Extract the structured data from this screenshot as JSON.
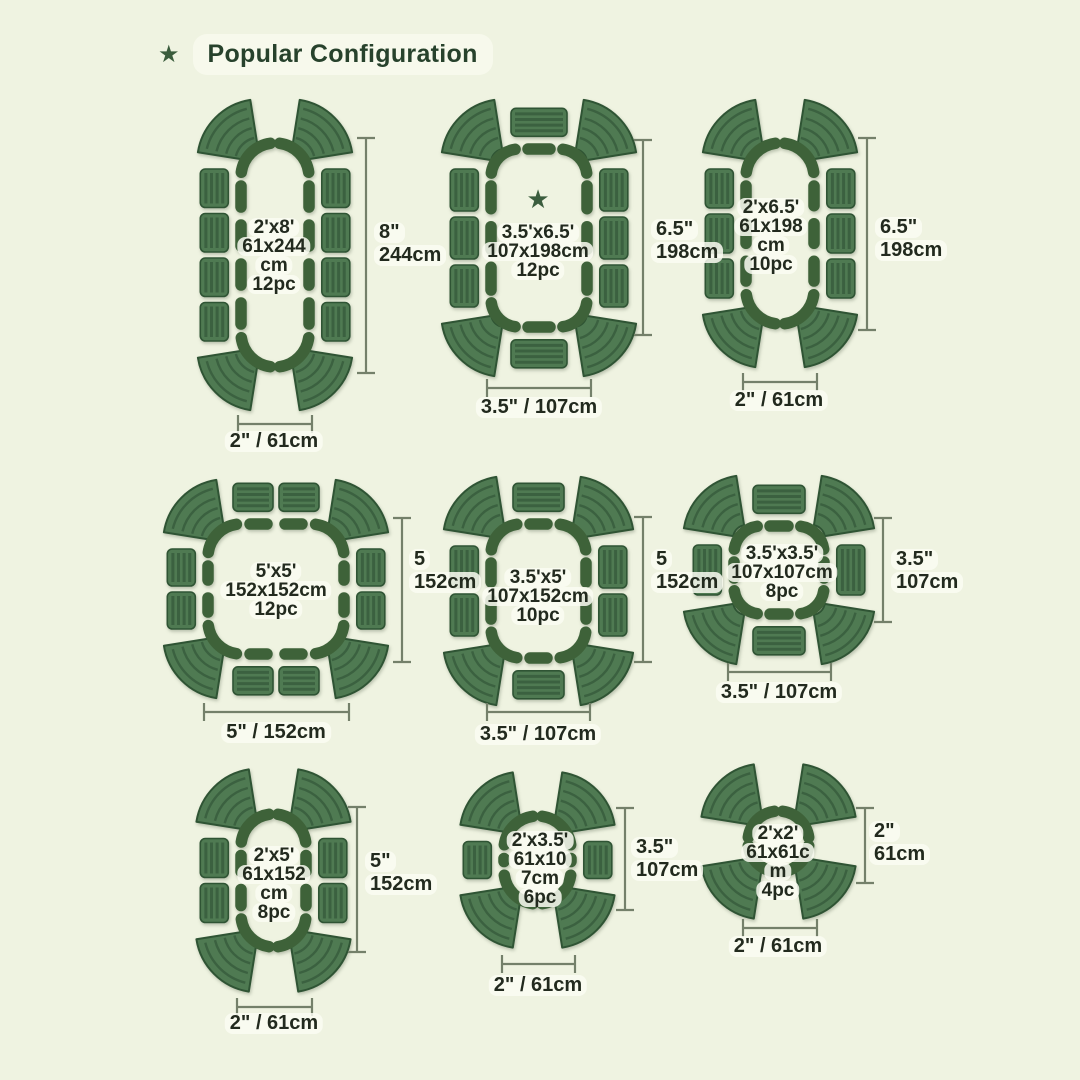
{
  "title": {
    "star": "★",
    "text": "Popular Configuration"
  },
  "colors": {
    "background": "#eff3e1",
    "title_text": "#27422c",
    "title_pill": "#f7f9ec",
    "bed_fill": "#4f7a52",
    "bed_stripe": "#3b6140",
    "bed_border": "#2f5434",
    "ring": "#3e6239",
    "dimension_line": "#74806a",
    "label_text": "#222a1e"
  },
  "configurations": [
    {
      "name": "2ft x 8ft",
      "center_lines": [
        "2'x8'",
        "61x244",
        "cm",
        "12pc"
      ],
      "height_lines": [
        "8\"",
        "244cm"
      ],
      "width_label": "2\" / 61cm",
      "featured": false,
      "layout": {
        "side_segments": 4,
        "top_segments": 0,
        "corner_segments": 4
      }
    },
    {
      "name": "3.5ft x 6.5ft",
      "center_lines": [
        "3.5'x6.5'",
        "107x198cm",
        "12pc"
      ],
      "height_lines": [
        "6.5\"",
        "198cm"
      ],
      "width_label": "3.5\" / 107cm",
      "featured": true,
      "featured_star": "★",
      "layout": {
        "side_segments": 3,
        "top_segments": 1,
        "corner_segments": 4
      }
    },
    {
      "name": "2ft x 6.5ft",
      "center_lines": [
        "2'x6.5'",
        "61x198",
        "cm",
        "10pc"
      ],
      "height_lines": [
        "6.5\"",
        "198cm"
      ],
      "width_label": "2\" / 61cm",
      "featured": false,
      "layout": {
        "side_segments": 3,
        "top_segments": 0,
        "corner_segments": 4
      }
    },
    {
      "name": "5ft x 5ft",
      "center_lines": [
        "5'x5'",
        "152x152cm",
        "12pc"
      ],
      "height_lines": [
        "5",
        "152cm"
      ],
      "width_label": "5\" / 152cm",
      "featured": false,
      "layout": {
        "side_segments": 2,
        "top_segments": 2,
        "corner_segments": 4
      }
    },
    {
      "name": "3.5ft x 5ft",
      "center_lines": [
        "3.5'x5'",
        "107x152cm",
        "10pc"
      ],
      "height_lines": [
        "5",
        "152cm"
      ],
      "width_label": "3.5\" / 107cm",
      "featured": false,
      "layout": {
        "side_segments": 2,
        "top_segments": 1,
        "corner_segments": 4
      }
    },
    {
      "name": "3.5ft x 3.5ft",
      "center_lines": [
        "3.5'x3.5'",
        "107x107cm",
        "8pc"
      ],
      "height_lines": [
        "3.5\"",
        "107cm"
      ],
      "width_label": "3.5\" / 107cm",
      "featured": false,
      "layout": {
        "side_segments": 1,
        "top_segments": 1,
        "corner_segments": 4
      }
    },
    {
      "name": "2ft x 5ft",
      "center_lines": [
        "2'x5'",
        "61x152",
        "cm",
        "8pc"
      ],
      "height_lines": [
        "5\"",
        "152cm"
      ],
      "width_label": "2\" / 61cm",
      "featured": false,
      "layout": {
        "side_segments": 2,
        "top_segments": 0,
        "corner_segments": 4
      }
    },
    {
      "name": "2ft x 3.5ft",
      "center_lines": [
        "2'x3.5'",
        "61x10",
        "7cm",
        "6pc"
      ],
      "height_lines": [
        "3.5\"",
        "107cm"
      ],
      "width_label": "2\" / 61cm",
      "featured": false,
      "layout": {
        "side_segments": 1,
        "top_segments": 0,
        "corner_segments": 4
      }
    },
    {
      "name": "2ft x 2ft",
      "center_lines": [
        "2'x2'",
        "61x61c",
        "m",
        "4pc"
      ],
      "height_lines": [
        "2\"",
        "61cm"
      ],
      "width_label": "2\" / 61cm",
      "featured": false,
      "layout": {
        "side_segments": 0,
        "top_segments": 0,
        "corner_segments": 4
      }
    }
  ]
}
